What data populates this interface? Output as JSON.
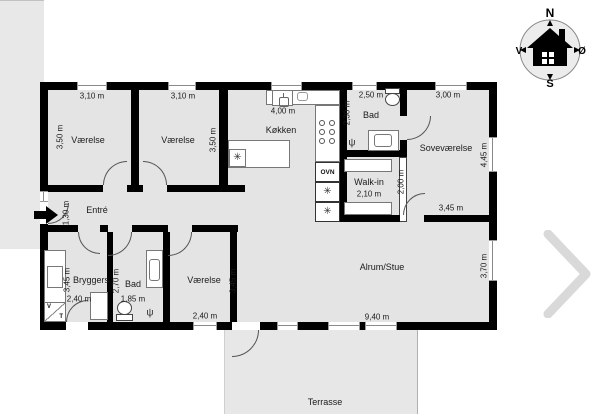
{
  "floorplan": {
    "rooms": {
      "vaerelse_nw": "Værelse",
      "vaerelse_n": "Værelse",
      "koekken": "Køkken",
      "bad_n": "Bad",
      "sovevaerelse": "Soveværelse",
      "walkin": "Walk-in",
      "entre": "Entré",
      "bryggers": "Bryggers",
      "bad_s": "Bad",
      "vaerelse_s": "Værelse",
      "alrum": "Alrum/Stue",
      "terrasse": "Terrasse"
    },
    "dimensions": {
      "vaerelse_nw_width": "3,10 m",
      "vaerelse_nw_depth": "3,50 m",
      "vaerelse_n_width": "3,10 m",
      "vaerelse_n_depth": "3,50 m",
      "koekken_width": "4,00 m",
      "bad_n_width": "2,50 m",
      "bad_n_depth": "2,30 m",
      "sovevaerelse_width": "3,00 m",
      "sovevaerelse_depth": "4,45 m",
      "sovevaerelse_south": "3,45 m",
      "walkin_width": "2,10 m",
      "walkin_depth": "2,00 m",
      "entre_width": "1,30 m",
      "bryggers_depth": "3,45 m",
      "bryggers_width": "2,40 m",
      "bad_s_depth": "2,70 m",
      "bad_s_width": "1,85 m",
      "vaerelse_s_depth": "3,45 m",
      "vaerelse_s_width": "2,40 m",
      "alrum_width": "9,40 m",
      "alrum_depth": "3,70 m"
    },
    "appliances": {
      "oven_label": "OVN",
      "washer_label": "V",
      "dryer_label": "T"
    },
    "icons": {
      "snowflake": "✳",
      "shower_drain": "ψ"
    },
    "compass": {
      "north": "N",
      "south": "S",
      "west": "V",
      "east": "Ø"
    },
    "colors": {
      "wall": "#000000",
      "floor": "#e4e4e4",
      "outdoor_area": "#e8e8e8",
      "background": "#ffffff"
    }
  }
}
